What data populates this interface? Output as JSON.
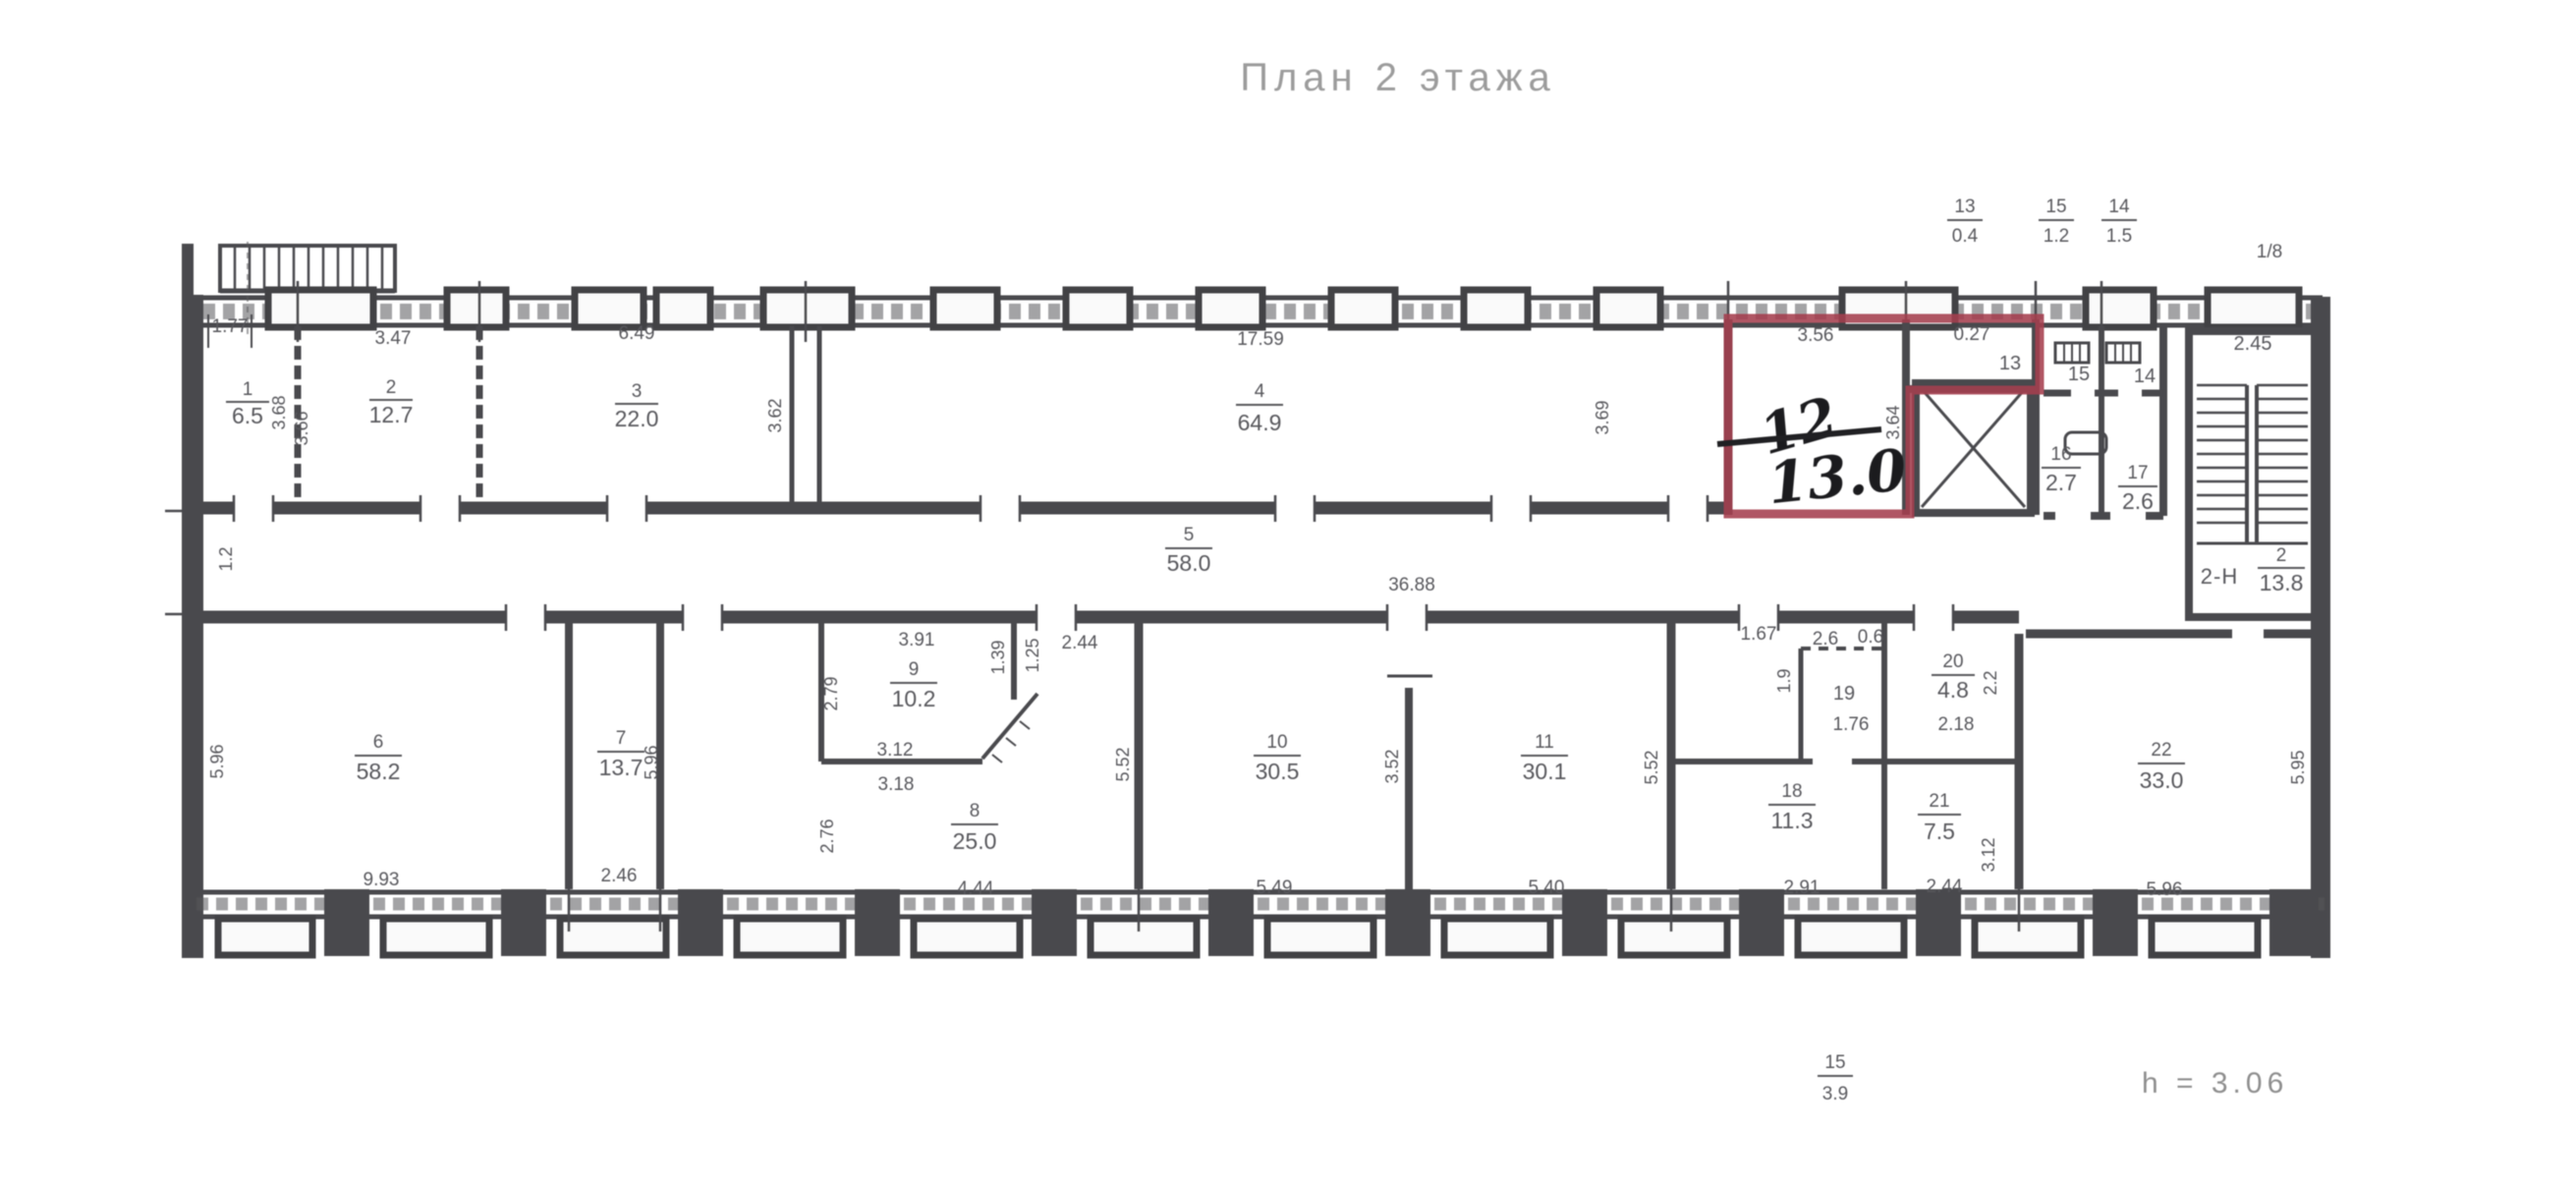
{
  "title": "План 2 этажа",
  "red_room": {
    "crossed_number": "12",
    "handwritten_value": "13.0"
  },
  "rooms": {
    "r1": {
      "num": "1",
      "area": "6.5"
    },
    "r2": {
      "num": "2",
      "area": "12.7"
    },
    "r3": {
      "num": "3",
      "area": "22.0"
    },
    "r4": {
      "num": "4",
      "area": "64.9"
    },
    "r5": {
      "num": "5",
      "area": "58.0"
    },
    "r6": {
      "num": "6",
      "area": "58.2"
    },
    "r7": {
      "num": "7",
      "area": "13.7"
    },
    "r8": {
      "num": "8",
      "area": "25.0"
    },
    "r9": {
      "num": "9",
      "area": "10.2"
    },
    "r10": {
      "num": "10",
      "area": "30.5"
    },
    "r11": {
      "num": "11",
      "area": "30.1"
    },
    "r16": {
      "num": "16",
      "area": "2.7"
    },
    "r17": {
      "num": "17",
      "area": "2.6"
    },
    "r18": {
      "num": "18",
      "area": "11.3"
    },
    "r20": {
      "num": "20",
      "area": "4.8"
    },
    "r21": {
      "num": "21",
      "area": "7.5"
    },
    "r22": {
      "num": "22",
      "area": "33.0"
    }
  },
  "solo_rooms": {
    "r13": "13",
    "r14": "14",
    "r15": "15",
    "r19": "19"
  },
  "stairwell": {
    "area": "2.45"
  },
  "unit_label": {
    "name": "2-Н",
    "num": "2",
    "area": "13.8"
  },
  "upper_notes": {
    "n13": {
      "num": "13",
      "area": "0.4"
    },
    "n15": {
      "num": "15",
      "area": "1.2"
    },
    "n14": {
      "num": "14",
      "area": "1.5"
    },
    "scale": "1/8"
  },
  "bottom_notes": {
    "n15": {
      "num": "15",
      "area": "3.9"
    },
    "height": "h = 3.06"
  },
  "dims": {
    "d01": "1.77",
    "d02": "3.47",
    "d03": "6.49",
    "d04": "17.59",
    "d05": "3.56",
    "d06": "0.27",
    "d07": "36.88",
    "d08": "9.93",
    "d09": "2.46",
    "d10": "3.91",
    "d11": "2.44",
    "d12": "3.12",
    "d13": "3.18",
    "d14": "4.44",
    "d15": "5.49",
    "d16": "5.40",
    "d17": "1.67",
    "d18": "1.76",
    "d19": "2.18",
    "d20": "2.91",
    "d21": "2.44",
    "d22": "5.96",
    "d23": "3.68",
    "d24": "3.66",
    "d25": "3.62",
    "d26": "3.69",
    "d27": "3.64",
    "d28": "5.96",
    "d29": "5.96",
    "d30": "2.79",
    "d31": "2.76",
    "d32": "1.39",
    "d33": "1.25",
    "d34": "5.52",
    "d35": "3.52",
    "d36": "5.52",
    "d37": "5.95",
    "d38": "3.12",
    "d39": "2.2",
    "d40": "1.9",
    "d41": "1.2",
    "d42": "2.6",
    "d43": "0.6"
  }
}
